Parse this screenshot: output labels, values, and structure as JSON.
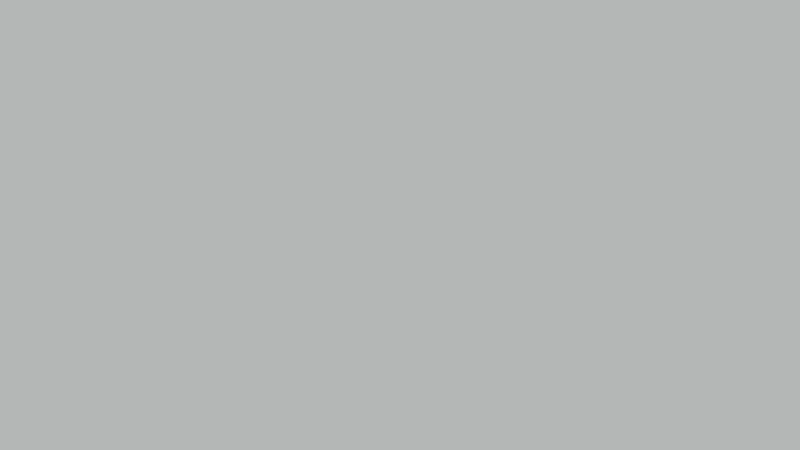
{
  "scene": {
    "type": "aerial-photograph",
    "subject": "top-down aerial view of an industrial logistics campus: four large warehouse roofs covered with solar panel arrays and white skylights, flanking access roads, a landscaped strip with trees along the top highway, dark service aprons and loading yards with trucks, trailers and parked cars",
    "orientation": "top-down"
  },
  "palette": {
    "road_light": "#b4b7b6",
    "sidewalk": "#c3c6c0",
    "apron_dark": "#33414a",
    "roof_white": "#dcdedd",
    "roof_gray": "#ced1d0",
    "roof_top_band": "#dfe1e0",
    "panel": "#66727a",
    "skylight": "#eceeed",
    "band_dark": "#323e44",
    "alley": "#c5c8c7",
    "tan": "#d2c5a6",
    "hedge": "#3c4934",
    "grass_light": "#b9bcb6",
    "grass_mid": "#9aa084",
    "grass_dark": "#8e9478",
    "bottom_apron": "#b3b6b5",
    "car_strip": "#9aa09e",
    "road_dark": "#404a4d",
    "road_bottom": "#272e31",
    "red": "#c0392b",
    "orange": "#c2502f",
    "white_truck": "#e9ebea",
    "dark_truck": "#23292c",
    "wall": "#c6c9c8"
  },
  "seed": 1337,
  "top_road": {
    "y": 0,
    "h": 13,
    "lane_dash": {
      "y": 5,
      "step": 22,
      "w": 9,
      "h": 1
    },
    "trucks": [
      {
        "x": 52,
        "y": 1,
        "w": 30,
        "h": 9,
        "body": "#e9ebea",
        "cab": "#22262a",
        "side": "right"
      },
      {
        "x": 118,
        "y": 2,
        "w": 14,
        "h": 8,
        "body": "#33383b"
      },
      {
        "x": 165,
        "y": 0,
        "w": 30,
        "h": 10,
        "body": "#e9ebea",
        "cab": "#1e2225",
        "side": "right"
      },
      {
        "x": 203,
        "y": 1,
        "w": 12,
        "h": 9,
        "body": "#2c3134"
      },
      {
        "x": 322,
        "y": 3,
        "w": 32,
        "h": 10,
        "body": "#2f3437",
        "cab": "#b03a2c",
        "side": "left"
      },
      {
        "x": 376,
        "y": 1,
        "w": 32,
        "h": 10,
        "body": "#eceeed",
        "cab": "#2a2e31",
        "side": "left"
      },
      {
        "x": 452,
        "y": 2,
        "w": 28,
        "h": 10,
        "body": "#e9ebea",
        "cab": "#33383b",
        "side": "right"
      },
      {
        "x": 557,
        "y": 0,
        "w": 34,
        "h": 10,
        "body": "#2c3134",
        "cab": "#c44434",
        "side": "right"
      },
      {
        "x": 645,
        "y": 0,
        "w": 22,
        "h": 9,
        "body": "#202528"
      },
      {
        "x": 683,
        "y": 1,
        "w": 26,
        "h": 10,
        "body": "#2d3235",
        "cab": "#c04030",
        "side": "left"
      },
      {
        "x": 738,
        "y": 0,
        "w": 27,
        "h": 9,
        "body": "#24292c",
        "cab": "#b63c2e",
        "side": "right"
      }
    ],
    "white_corner": {
      "x": 113,
      "y": 0,
      "w": 32,
      "h": 16
    }
  },
  "car_row_top": {
    "x0": 6,
    "y": 11,
    "step": 9.6,
    "count": 82,
    "w": 7,
    "h": 9,
    "colors": [
      "#3a4043",
      "#555b5d",
      "#2d3235",
      "#697072",
      "#494f52",
      "#d9dcdb",
      "#30363a",
      "#5e6466"
    ]
  },
  "green_strip": {
    "y": 21,
    "h": 37,
    "tree_count": 95,
    "tree_colors": [
      "#4e6b3e",
      "#5d7a48",
      "#6b8852",
      "#47633a",
      "#778a58",
      "#3f5a35"
    ],
    "flower_patches": [
      {
        "x": 304,
        "y": 27,
        "w": 44,
        "h": 13,
        "color": "#9c4f3c"
      },
      {
        "x": 450,
        "y": 28,
        "w": 48,
        "h": 13,
        "color": "#a2543e"
      },
      {
        "x": 355,
        "y": 30,
        "w": 20,
        "h": 9,
        "color": "#8a5a40"
      },
      {
        "x": 0,
        "y": 29,
        "w": 24,
        "h": 12,
        "color": "#8a6a4e"
      },
      {
        "x": 505,
        "y": 27,
        "w": 26,
        "h": 9,
        "color": "#97815c"
      },
      {
        "x": 660,
        "y": 26,
        "w": 34,
        "h": 10,
        "color": "#8f7a55"
      }
    ],
    "paths": [
      {
        "x": 0,
        "y": 45,
        "w": 120,
        "h": 3
      },
      {
        "x": 150,
        "y": 43,
        "w": 140,
        "h": 3
      }
    ],
    "loop_feature": {
      "x": 30,
      "y": 27,
      "w": 36,
      "h": 21
    },
    "loop_car": {
      "x": 40,
      "y": 36,
      "w": 8,
      "h": 5,
      "color": "#2e3436"
    },
    "sapling_rows": {
      "x0": 545,
      "x1": 793,
      "step": 11,
      "rows": [
        40,
        47,
        54
      ],
      "color": "#3f5a35"
    }
  },
  "wall": {
    "y": 58,
    "h": 4
  },
  "apron": {
    "y": 62,
    "h": 35,
    "bridge": {
      "x": 384,
      "y": 58,
      "w": 17,
      "h": 40
    },
    "trucks": [
      {
        "x": 126,
        "y": 63,
        "w": 15,
        "h": 7,
        "c": "#23292c"
      },
      {
        "x": 170,
        "y": 62,
        "w": 11,
        "h": 6,
        "c": "#2a3033"
      },
      {
        "x": 237,
        "y": 56,
        "w": 25,
        "h": 9,
        "c": "#23292c",
        "a": "#c2502f"
      },
      {
        "x": 268,
        "y": 59,
        "w": 27,
        "h": 6,
        "c": "#1d2326"
      },
      {
        "x": 329,
        "y": 62,
        "w": 16,
        "h": 8,
        "c": "#23292c"
      },
      {
        "x": 352,
        "y": 63,
        "w": 14,
        "h": 7,
        "c": "#dfe2e1"
      },
      {
        "x": 409,
        "y": 63,
        "w": 16,
        "h": 8,
        "c": "#262c2f"
      },
      {
        "x": 433,
        "y": 62,
        "w": 10,
        "h": 6,
        "c": "#2a3033"
      },
      {
        "x": 468,
        "y": 64,
        "w": 14,
        "h": 7,
        "c": "#23292c"
      },
      {
        "x": 543,
        "y": 60,
        "w": 16,
        "h": 8,
        "c": "#22282b"
      },
      {
        "x": 578,
        "y": 62,
        "w": 12,
        "h": 7,
        "c": "#e4e6e5"
      },
      {
        "x": 623,
        "y": 59,
        "w": 14,
        "h": 8,
        "c": "#262c2f"
      },
      {
        "x": 654,
        "y": 55,
        "w": 33,
        "h": 9,
        "c": "#c2502f"
      },
      {
        "x": 700,
        "y": 61,
        "w": 16,
        "h": 8,
        "c": "#23292c"
      },
      {
        "x": 748,
        "y": 57,
        "w": 22,
        "h": 7,
        "c": "#c2502f"
      },
      {
        "x": 775,
        "y": 60,
        "w": 14,
        "h": 7,
        "c": "#23292c"
      }
    ],
    "docked": [
      {
        "x": 560,
        "y": 76,
        "w": 6,
        "h": 13,
        "c": "#d9dcdb"
      },
      {
        "x": 598,
        "y": 70,
        "w": 7,
        "h": 15,
        "c": "#e2e4e3"
      },
      {
        "x": 623,
        "y": 76,
        "w": 6,
        "h": 13,
        "c": "#dadddc"
      },
      {
        "x": 658,
        "y": 74,
        "w": 6,
        "h": 12,
        "c": "#d5d8d7"
      },
      {
        "x": 723,
        "y": 70,
        "w": 15,
        "h": 6,
        "c": "#dfe2e1"
      },
      {
        "x": 368,
        "y": 76,
        "w": 7,
        "h": 11,
        "c": "#27323a"
      },
      {
        "x": 300,
        "y": 78,
        "w": 9,
        "h": 9,
        "c": "#27323a"
      },
      {
        "x": 180,
        "y": 80,
        "w": 10,
        "h": 7,
        "c": "#2a363e"
      }
    ],
    "shadows": [
      {
        "x": 180,
        "y": 78,
        "w": 60,
        "h": 14
      },
      {
        "x": 420,
        "y": 80,
        "w": 70,
        "h": 12
      },
      {
        "x": 640,
        "y": 82,
        "w": 60,
        "h": 10
      }
    ]
  },
  "buildings": {
    "left": {
      "x": 0,
      "y": 95,
      "w": 76,
      "h": 285,
      "strips": [
        {
          "x": 20,
          "w": 15
        },
        {
          "x": 50,
          "w": 16
        }
      ],
      "skylight_cols": [
        12,
        40,
        69
      ],
      "edge_dash_x": 2,
      "bands": [
        194,
        289
      ],
      "top_band_h": 8,
      "bottom_band_y": 372
    },
    "alley_left": {
      "x": 76,
      "y": 95,
      "w": 14,
      "h": 285
    },
    "a": {
      "x": 90,
      "y": 97,
      "w": 296,
      "sections": [
        {
          "y": 103,
          "h": 124,
          "row0": 105,
          "rows": 6
        },
        {
          "y": 247,
          "h": 123,
          "row0": 255,
          "rows": 5
        }
      ],
      "cols": {
        "x0": 99,
        "step": 24,
        "n": 12
      },
      "midband": {
        "y": 227,
        "h": 20,
        "seg_x0": 97,
        "seg_w": 48,
        "seg_gap": 10,
        "n": 5
      },
      "seam_x": 241,
      "bottom_y": 370
    },
    "center_strip": {
      "x": 386,
      "y": 97,
      "w": 17,
      "h": 278,
      "walkway": {
        "x": 387,
        "y": 97,
        "w": 15,
        "h": 44
      },
      "tan_patch": {
        "x": 388,
        "y": 143,
        "w": 13,
        "h": 71
      },
      "dark_patches": [
        {
          "x": 390,
          "y": 186,
          "w": 13,
          "h": 46
        },
        {
          "x": 387,
          "y": 312,
          "w": 14,
          "h": 26
        }
      ],
      "dots": [
        {
          "x": 391,
          "y": 252,
          "w": 9,
          "h": 7
        },
        {
          "x": 390,
          "y": 287,
          "w": 8,
          "h": 5
        }
      ]
    },
    "b": {
      "x": 403,
      "y": 97,
      "w": 284,
      "sections": [
        {
          "y": 103,
          "h": 124,
          "row0": 105,
          "rows": 6
        },
        {
          "y": 247,
          "h": 123,
          "row0": 255,
          "rows": 5
        }
      ],
      "cols": {
        "x0": 411,
        "step": 23,
        "n": 12
      },
      "midband": {
        "y": 227,
        "h": 20,
        "seg_x0": 410,
        "seg_w": 46,
        "seg_gap": 10,
        "n": 5
      },
      "seam_x": 545,
      "bottom_y": 370
    },
    "alley_right": {
      "x": 687,
      "y": 95,
      "w": 12,
      "h": 277,
      "notch": {
        "x": 683,
        "y": 228,
        "w": 16,
        "h": 20
      }
    },
    "right": {
      "x": 699,
      "y": 95,
      "w": 103,
      "h": 277,
      "grid": {
        "x0": 702,
        "y0": 100,
        "dx": 14.3,
        "dy": 14.5,
        "cols": 7,
        "rows": 19
      },
      "bands": [
        181,
        273
      ]
    }
  },
  "bottom": {
    "dock_bands": [
      {
        "x": 90,
        "y": 370,
        "w": 296,
        "h": 15,
        "dash_y": 374
      },
      {
        "x": 403,
        "y": 370,
        "w": 284,
        "h": 15,
        "dash_y": 374
      },
      {
        "x": 0,
        "y": 372,
        "w": 76,
        "h": 10,
        "dash_y": 378
      },
      {
        "x": 687,
        "y": 368,
        "w": 115,
        "h": 17,
        "dash_y": 371
      }
    ],
    "apron": {
      "y": 383,
      "h": 33
    },
    "streaks": [
      {
        "x": 150
      },
      {
        "x": 420
      },
      {
        "x": 640
      }
    ],
    "trucks": [
      {
        "x": 10,
        "y": 377,
        "w": 14,
        "h": 8,
        "c": "#2c3336"
      },
      {
        "x": 44,
        "y": 384,
        "w": 31,
        "h": 13,
        "c": "#242e2c"
      },
      {
        "x": 94,
        "y": 389,
        "w": 32,
        "h": 13,
        "c": "#222c2a"
      },
      {
        "x": 129,
        "y": 399,
        "w": 31,
        "h": 12,
        "c": "#dcdfde"
      },
      {
        "x": 163,
        "y": 397,
        "w": 31,
        "h": 13,
        "c": "#262f2d"
      },
      {
        "x": 197,
        "y": 400,
        "w": 31,
        "h": 13,
        "c": "#232d2b"
      },
      {
        "x": 222,
        "y": 373,
        "w": 9,
        "h": 21,
        "c": "#c0392b"
      },
      {
        "x": 252,
        "y": 378,
        "w": 29,
        "h": 11,
        "c": "#cfc2a2"
      },
      {
        "x": 282,
        "y": 379,
        "w": 6,
        "h": 9,
        "c": "#b8432f"
      },
      {
        "x": 310,
        "y": 377,
        "w": 33,
        "h": 14,
        "c": "#27302e"
      },
      {
        "x": 352,
        "y": 383,
        "w": 14,
        "h": 8,
        "c": "#2c3634"
      },
      {
        "x": 433,
        "y": 373,
        "w": 8,
        "h": 20,
        "c": "#e6e8e7"
      },
      {
        "x": 456,
        "y": 375,
        "w": 8,
        "h": 18,
        "c": "#e2e4e3"
      },
      {
        "x": 490,
        "y": 371,
        "w": 9,
        "h": 22,
        "c": "#d8dbda"
      },
      {
        "x": 523,
        "y": 374,
        "w": 8,
        "h": 18,
        "c": "#2b3533"
      },
      {
        "x": 555,
        "y": 373,
        "w": 8,
        "h": 20,
        "c": "#242e2c"
      },
      {
        "x": 585,
        "y": 376,
        "w": 8,
        "h": 13,
        "c": "#b8402e"
      },
      {
        "x": 607,
        "y": 378,
        "w": 8,
        "h": 13,
        "c": "#c24a33"
      },
      {
        "x": 642,
        "y": 380,
        "w": 31,
        "h": 11,
        "c": "#1f2729"
      },
      {
        "x": 762,
        "y": 384,
        "w": 30,
        "h": 11,
        "c": "#20282a"
      }
    ],
    "red_containers": [
      {
        "x": 718,
        "y": 374,
        "w": 12,
        "h": 21
      },
      {
        "x": 750,
        "y": 374,
        "w": 12,
        "h": 21
      }
    ],
    "van_row": {
      "x0": 432,
      "y": 401,
      "step": 9.5,
      "count": 38,
      "w": 7,
      "h": 15,
      "colors": {
        "dark": "#252b28",
        "red": "#b8402e",
        "white": "#dfe2e1"
      }
    },
    "hedge": {
      "x0": 40,
      "y": 413,
      "w": 760,
      "h": 11,
      "canopy": {
        "x": 440,
        "y": 411,
        "w": 47,
        "h": 9
      },
      "blob_colors": [
        "#36442e",
        "#2e3b29",
        "#41503a"
      ]
    },
    "car_strip": {
      "y": 422,
      "h": 11
    },
    "car_row": {
      "x0": 95,
      "y": 423,
      "step": 12.2,
      "count": 57,
      "w": 9,
      "h": 7,
      "colors": [
        "#41484a",
        "#d6d9d8",
        "#2e3436",
        "#5c6365",
        "#777d7f",
        "#30373a",
        "#e1e3e2",
        "#4a5153"
      ]
    },
    "road": {
      "y": 431,
      "h": 19,
      "dash_y": 437,
      "dark_strip_y": 444,
      "vehicles": [
        {
          "x": 100,
          "y": 428,
          "w": 10,
          "h": 6,
          "c": "#d8dbda"
        },
        {
          "x": 165,
          "y": 430,
          "w": 9,
          "h": 6,
          "c": "#2f3537"
        },
        {
          "x": 200,
          "y": 431,
          "w": 10,
          "h": 6,
          "c": "#51585a"
        },
        {
          "x": 242,
          "y": 429,
          "w": 9,
          "h": 6,
          "c": "#d5d8d7"
        },
        {
          "x": 305,
          "y": 432,
          "w": 11,
          "h": 6,
          "c": "#2c3234"
        },
        {
          "x": 360,
          "y": 430,
          "w": 10,
          "h": 6,
          "c": "#e2e4e3"
        },
        {
          "x": 412,
          "y": 440,
          "w": 26,
          "h": 8,
          "c": "#23292b"
        },
        {
          "x": 470,
          "y": 433,
          "w": 10,
          "h": 6,
          "c": "#565d5f"
        },
        {
          "x": 540,
          "y": 430,
          "w": 10,
          "h": 6,
          "c": "#d8dbda"
        },
        {
          "x": 600,
          "y": 437,
          "w": 44,
          "h": 9,
          "c": "#1c2224"
        },
        {
          "x": 660,
          "y": 430,
          "w": 10,
          "h": 6,
          "c": "#2e3436"
        },
        {
          "x": 720,
          "y": 432,
          "w": 10,
          "h": 6,
          "c": "#dadddc"
        },
        {
          "x": 762,
          "y": 429,
          "w": 9,
          "h": 6,
          "c": "#383f41"
        }
      ]
    },
    "left_dark": {
      "x": 0,
      "y": 410,
      "w": 46,
      "h": 40
    },
    "red_truck": {
      "x": 8,
      "y": 432,
      "w": 30,
      "h": 15
    }
  }
}
